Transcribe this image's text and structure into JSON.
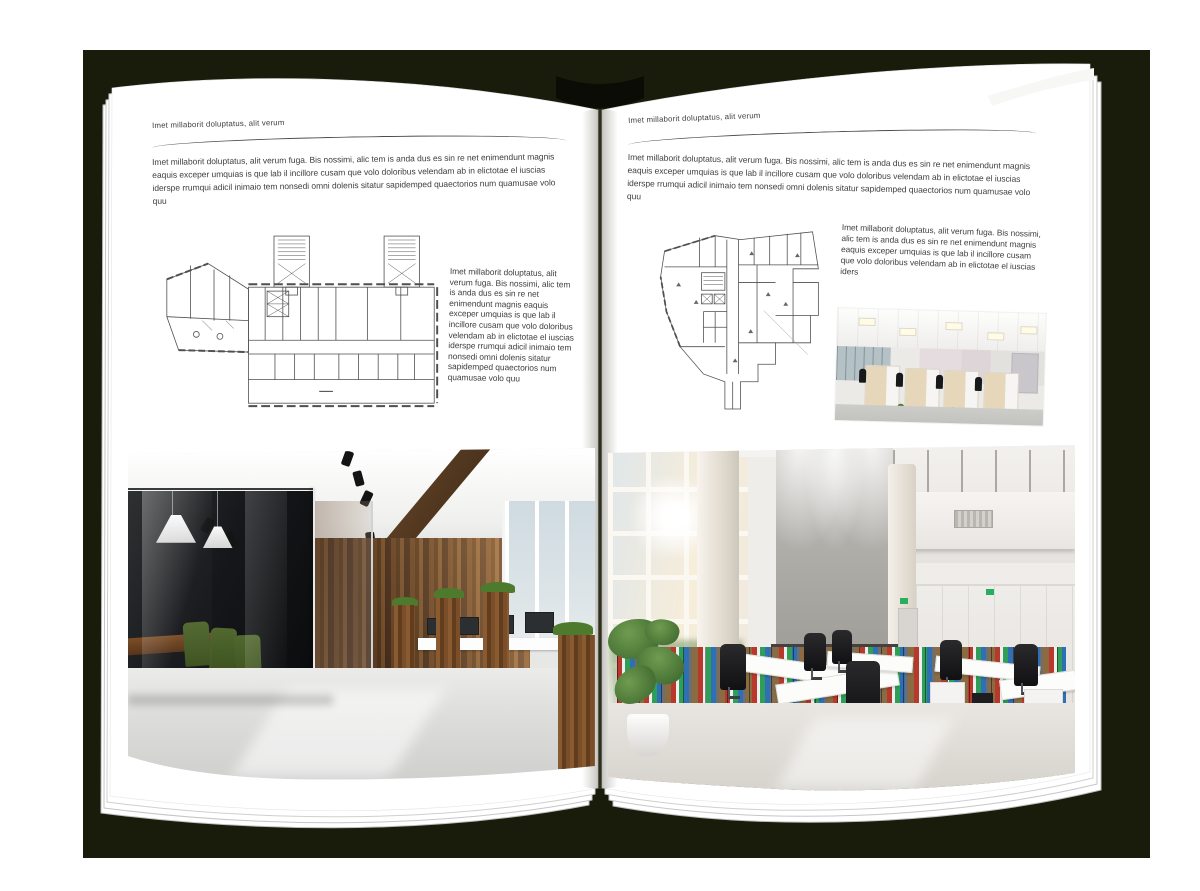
{
  "spread": {
    "left_page": {
      "header": "Imet millaborit doluptatus, alit verum",
      "intro": "Imet millaborit doluptatus, alit verum fuga. Bis nossimi, alic tem is anda dus es sin re net enimendunt magnis eaquis exceper umquias is que lab il incillore cusam que volo doloribus velendam ab in elictotae el iuscias iderspe rrumqui adicil inimaio tem nonsedi omni dolenis sitatur sapidemped quaectorios num quamusae volo quu",
      "side_text": "Imet millaborit doluptatus, alit verum fuga. Bis nossimi, alic tem is anda dus es sin re net enimendunt magnis eaquis exceper umquias is que lab il incillore cusam que volo doloribus velendam ab in elictotae el iuscias iderspe rrumqui adicil inimaio tem nonsedi omni dolenis sitatur sapidemped quaectorios num quamusae volo quu",
      "figures": {
        "floorplan": "architectural floor plan scan",
        "photo": "loft office with glass meeting room, green chairs and wood wall"
      }
    },
    "right_page": {
      "header": "Imet millaborit doluptatus, alit verum",
      "intro": "Imet millaborit doluptatus, alit verum fuga. Bis nossimi, alic tem is anda dus es sin re net enimendunt magnis eaquis exceper umquias is que lab il incillore cusam que volo doloribus velendam ab in elictotae el iuscias iderspe rrumqui adicil inimaio tem nonsedi omni dolenis sitatur sapidemped quaectorios num quamusae volo quu",
      "side_text": "Imet millaborit doluptatus, alit verum fuga. Bis nossimi, alic tem is anda dus es sin re net enimendunt magnis eaquis exceper umquias is que lab il incillore cusam que volo doloribus velendam ab in elictotae el iuscias iders",
      "figures": {
        "floorplan": "architectural floor plan scan",
        "photo_small": "open-plan office cubicle row",
        "photo_large": "bright double-height office with window wall, binder shelves and white desks"
      }
    },
    "colors": {
      "backdrop": "#1a1c0b",
      "page": "#ffffff",
      "text": "#3f3f3f"
    }
  }
}
